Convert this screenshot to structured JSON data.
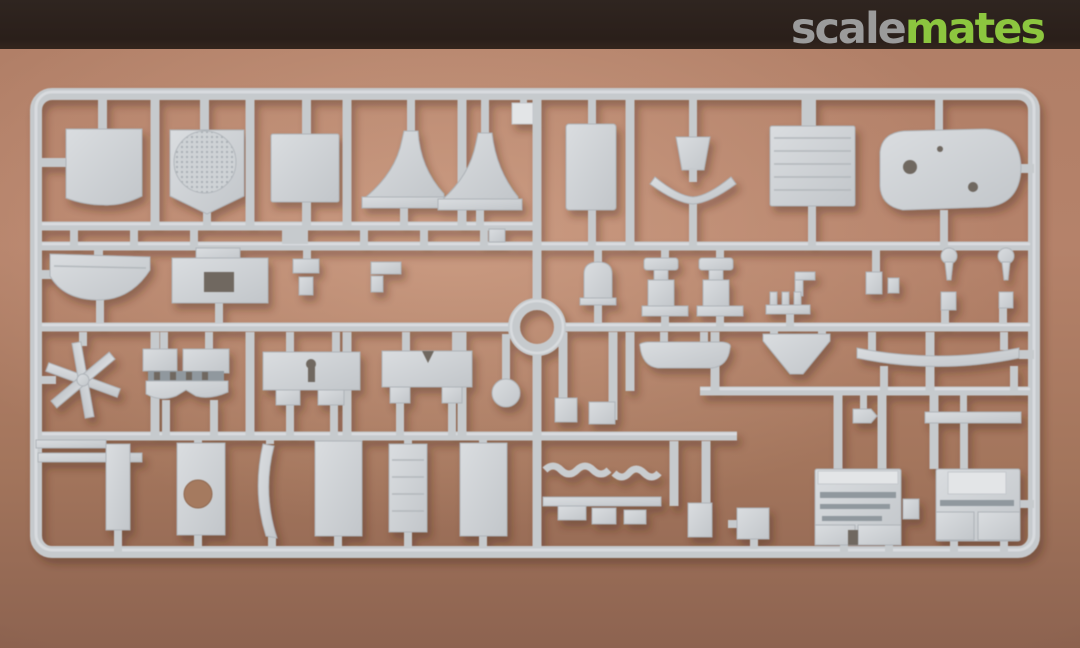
{
  "watermark": {
    "scale": "scale",
    "mates": "mates"
  },
  "colors": {
    "banner": "#2b211c",
    "logo_scale": "#9b9b9b",
    "logo_mates": "#8cc63f",
    "cork_background": "#b28069",
    "cork_background_dark": "#8d6350",
    "sprue_plastic": "#c6cacd",
    "part_highlight": "#e3e5e7",
    "recess_dark": "#6f6861"
  },
  "scene": {
    "type": "photograph",
    "subject": "light grey injection-moulded styrene sprue of a plastic scale-model kit",
    "surface": "brown cork mat",
    "orientation": "sprue lies horizontally, filling most of the frame",
    "center_ring": true,
    "approx_part_count": 60,
    "notable_parts": [
      "square panel with curved lower edge",
      "shield plate with meshed circular hatch",
      "plain square deck panel",
      "pair of flared funnel / vent stacks on base strips",
      "small square tag",
      "tall rectangular panel",
      "small funnel with winged bracket",
      "hatched grille square",
      "rounded boat-hull half with sink marks",
      "curved awning / tub section",
      "deck house with dark opening",
      "six-blade propeller star",
      "bridge wing with dark window band",
      "bulkhead panel with keyhole slot",
      "bulkhead panel with notch and legs",
      "small round disc",
      "two winch pedestals",
      "davit hooks and comb rack",
      "round-headed pins",
      "long rounded boat strip",
      "yoke bracket",
      "long curved deck blade",
      "plate with round hole",
      "curved rib strip",
      "large rectangular panels",
      "louvered ribbed panel",
      "anchor-chain strips",
      "two detailed superstructure blocks"
    ]
  }
}
